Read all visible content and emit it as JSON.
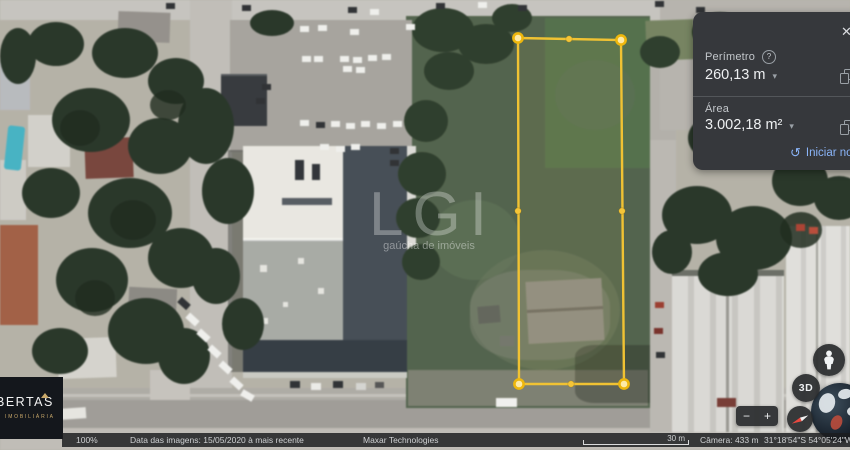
{
  "measure_panel": {
    "close_icon": "✕",
    "perimeter": {
      "label": "Perímetro",
      "help_icon": "?",
      "value": "260,13 m",
      "dropdown_icon": "▾"
    },
    "area": {
      "label": "Área",
      "value": "3.002,18 m²",
      "dropdown_icon": "▾"
    },
    "restart": {
      "icon": "↺",
      "label": "Iniciar novo"
    }
  },
  "status_bar": {
    "zoom_level": "100%",
    "imagery_date": "Data das imagens: 15/05/2020 à mais recente",
    "provider": "Maxar Technologies",
    "scale_label": "30 m",
    "camera_altitude": "Câmera: 433 m",
    "coordinates": "31°18'54\"S 54°05'24\"W"
  },
  "map_controls": {
    "zoom_out_label": "−",
    "zoom_in_label": "+",
    "mode_3d_label": "3D"
  },
  "watermarks": {
    "center_title": "LGI",
    "center_subtitle": "gaúcha de imóveis",
    "logo_title": "BERTAS",
    "logo_subtitle": "IMOBILIÁRIA"
  },
  "measurement": {
    "points_attr": "518,38 621,40 624,384 519,384",
    "stroke_color": "#f0c233",
    "fill_color": "rgba(255,228,92,0.06)",
    "handles": [
      {
        "x": 518,
        "y": 38,
        "r": 4.6,
        "type": "corner"
      },
      {
        "x": 621,
        "y": 40,
        "r": 4.6,
        "type": "corner"
      },
      {
        "x": 624,
        "y": 384,
        "r": 4.6,
        "type": "corner"
      },
      {
        "x": 519,
        "y": 384,
        "r": 4.6,
        "type": "corner"
      },
      {
        "x": 569,
        "y": 39,
        "r": 3.2,
        "type": "mid"
      },
      {
        "x": 622,
        "y": 211,
        "r": 3.2,
        "type": "mid"
      },
      {
        "x": 571,
        "y": 384,
        "r": 3.2,
        "type": "mid"
      },
      {
        "x": 518,
        "y": 211,
        "r": 3.2,
        "type": "mid"
      }
    ]
  },
  "colors": {
    "panel_bg": "#36383c",
    "accent_link": "#8ab4f8",
    "measure_yellow": "#f0c233",
    "field_green": "#51644b"
  }
}
